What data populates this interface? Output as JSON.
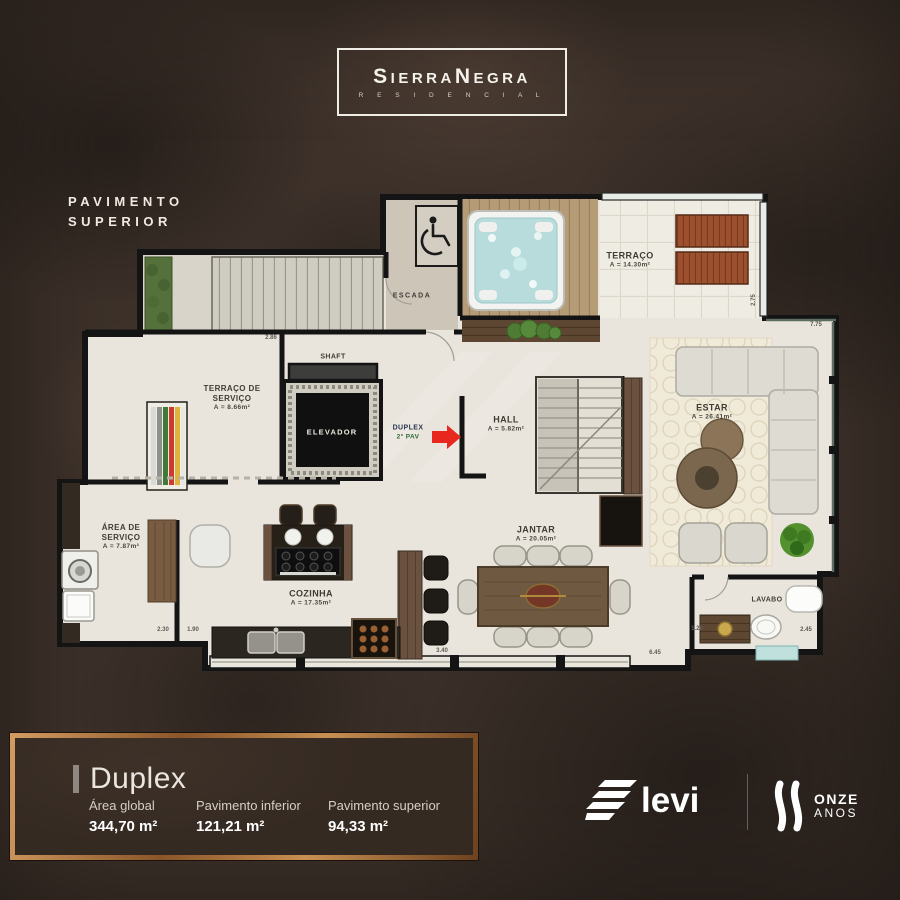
{
  "header": {
    "brand": "SierraNegra",
    "brand_sub": "R E S I D E N C I A L",
    "floor_line1": "PAVIMENTO",
    "floor_line2": "SUPERIOR"
  },
  "plan": {
    "rooms": {
      "escada": {
        "name": "ESCADA"
      },
      "terraco": {
        "name": "TERRAÇO",
        "area": "A = 14.30m²"
      },
      "terraco_servico": {
        "name1": "TERRAÇO DE",
        "name2": "SERVIÇO",
        "area": "A = 8.66m²"
      },
      "shaft": {
        "name": "SHAFT"
      },
      "elevador": {
        "name": "ELEVADOR"
      },
      "duplex": {
        "name": "DUPLEX",
        "sub": "2° PAV"
      },
      "hall": {
        "name": "HALL",
        "area": "A = 5.82m²"
      },
      "estar": {
        "name": "ESTAR",
        "area": "A = 26.41m²"
      },
      "area_servico": {
        "name1": "ÁREA DE",
        "name2": "SERVIÇO",
        "area": "A = 7.87m²"
      },
      "cozinha": {
        "name": "COZINHA",
        "area": "A = 17.35m²"
      },
      "jantar": {
        "name": "JANTAR",
        "area": "A = 20.05m²"
      },
      "lavabo": {
        "name": "LAVABO"
      }
    },
    "dimensions": [
      {
        "value": "2.86"
      },
      {
        "value": "2.30"
      },
      {
        "value": "1.90"
      },
      {
        "value": "3.40"
      },
      {
        "value": "6.45"
      },
      {
        "value": "1.26"
      },
      {
        "value": "2.45"
      },
      {
        "value": "2.75"
      },
      {
        "value": "7.75"
      }
    ],
    "colors": {
      "arrow_red": "#e8281e",
      "wall": "#141414",
      "floor": "#e9e5dd"
    }
  },
  "footer": {
    "unit_title": "Duplex",
    "stats": [
      {
        "label": "Área global",
        "value": "344,70 m²"
      },
      {
        "label": "Pavimento inferior",
        "value": "121,21 m²"
      },
      {
        "label": "Pavimento superior",
        "value": "94,33 m²"
      }
    ],
    "elevi_text": "levi",
    "anniversary_line1": "ONZE",
    "anniversary_line2": "ANOS",
    "colors": {
      "copper_frame": "#b07a48",
      "panel_bg": "#362b23"
    }
  }
}
